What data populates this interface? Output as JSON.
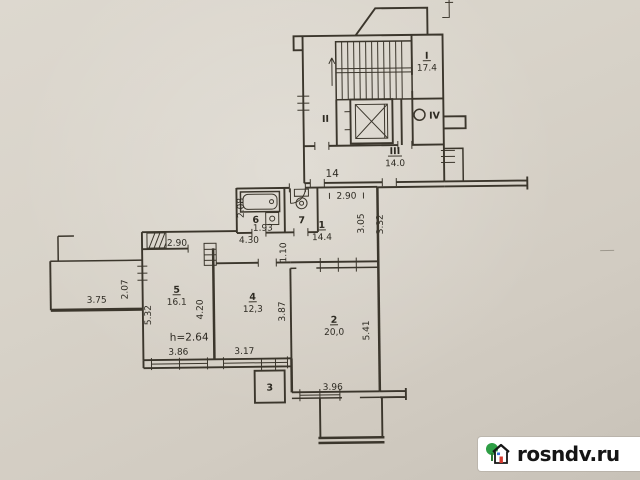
{
  "photo": {
    "type": "apartment floor plan (BTI drawing photo)",
    "paper_color": "#d8d3c9",
    "ink_color": "#3b362c"
  },
  "watermark": {
    "site": "rosndv.ru"
  },
  "rooms": {
    "stairI": {
      "label": "I",
      "area": "17.4"
    },
    "II": {
      "label": "II"
    },
    "III": {
      "label": "III",
      "area": "14.0"
    },
    "IV": {
      "label": "IV"
    },
    "r1": {
      "label": "1",
      "area": "14.4"
    },
    "r2": {
      "label": "2",
      "area": "20,0"
    },
    "r3": {
      "label": "3"
    },
    "r4": {
      "label": "4",
      "area": "12,3"
    },
    "r5": {
      "label": "5",
      "area": "16.1"
    },
    "r6": {
      "label": "6"
    },
    "r7": {
      "label": "7"
    }
  },
  "annotations": {
    "apartment_number": "14",
    "ceiling_height": "h=2.64"
  },
  "dims": {
    "hall_width_top": "2.90",
    "hall_depth_left": "3.05",
    "hall_depth_right": "3.32",
    "bath_depth": "2.08",
    "bath_width": "1.93",
    "corridor_length": "4.30",
    "passage_width": "1.10",
    "room5_top": "2.90",
    "balcony_left_width": "3.75",
    "balcony_left_depth": "2.07",
    "room5_left": "5.32",
    "room5_right": "4.20",
    "room5_bottom": "3.86",
    "room4_bottom": "3.17",
    "room4_right": "3.87",
    "room2_right": "5.41",
    "room2_bottom": "3.96"
  }
}
